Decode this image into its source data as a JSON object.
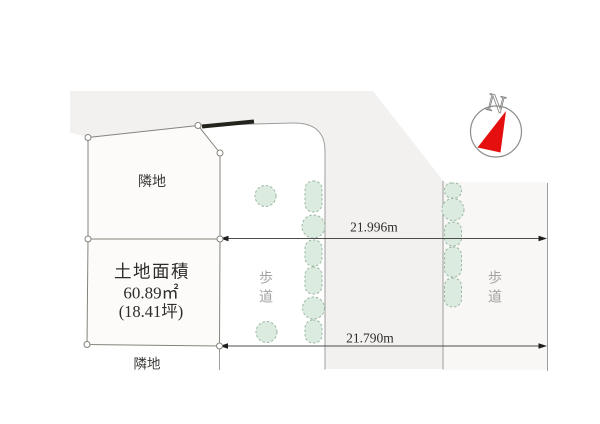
{
  "diagram": {
    "adjacent_land_top": "隣地",
    "adjacent_land_bottom": "隣地",
    "land_area": {
      "title": "土地面積",
      "area_sqm": "60.89㎡",
      "area_tsubo": "(18.41坪)"
    },
    "dimensions": {
      "top_length": "21.996m",
      "bottom_length": "21.790m"
    },
    "sidewalk_left_label": "歩道",
    "sidewalk_right_label": "歩道",
    "compass": {
      "north_label": "N"
    }
  },
  "colors": {
    "background": "#ffffff",
    "road_fill": "#f2f1f0",
    "sidewalk_fill": "#f8f7f6",
    "plot_fill": "#fcfbfa",
    "plot_stroke": "#84837b",
    "road_line": "#9e9e9c",
    "dimension_line": "#4c4c4a",
    "arrow_black": "#1e1e1c",
    "tree_fill": "#dcebe0",
    "tree_stroke": "#9bb9a3",
    "north_red": "#e60f0f",
    "text_dark": "#2e2d2b",
    "text_gray": "#a2a2a0",
    "wall_marker": "#24241e"
  }
}
